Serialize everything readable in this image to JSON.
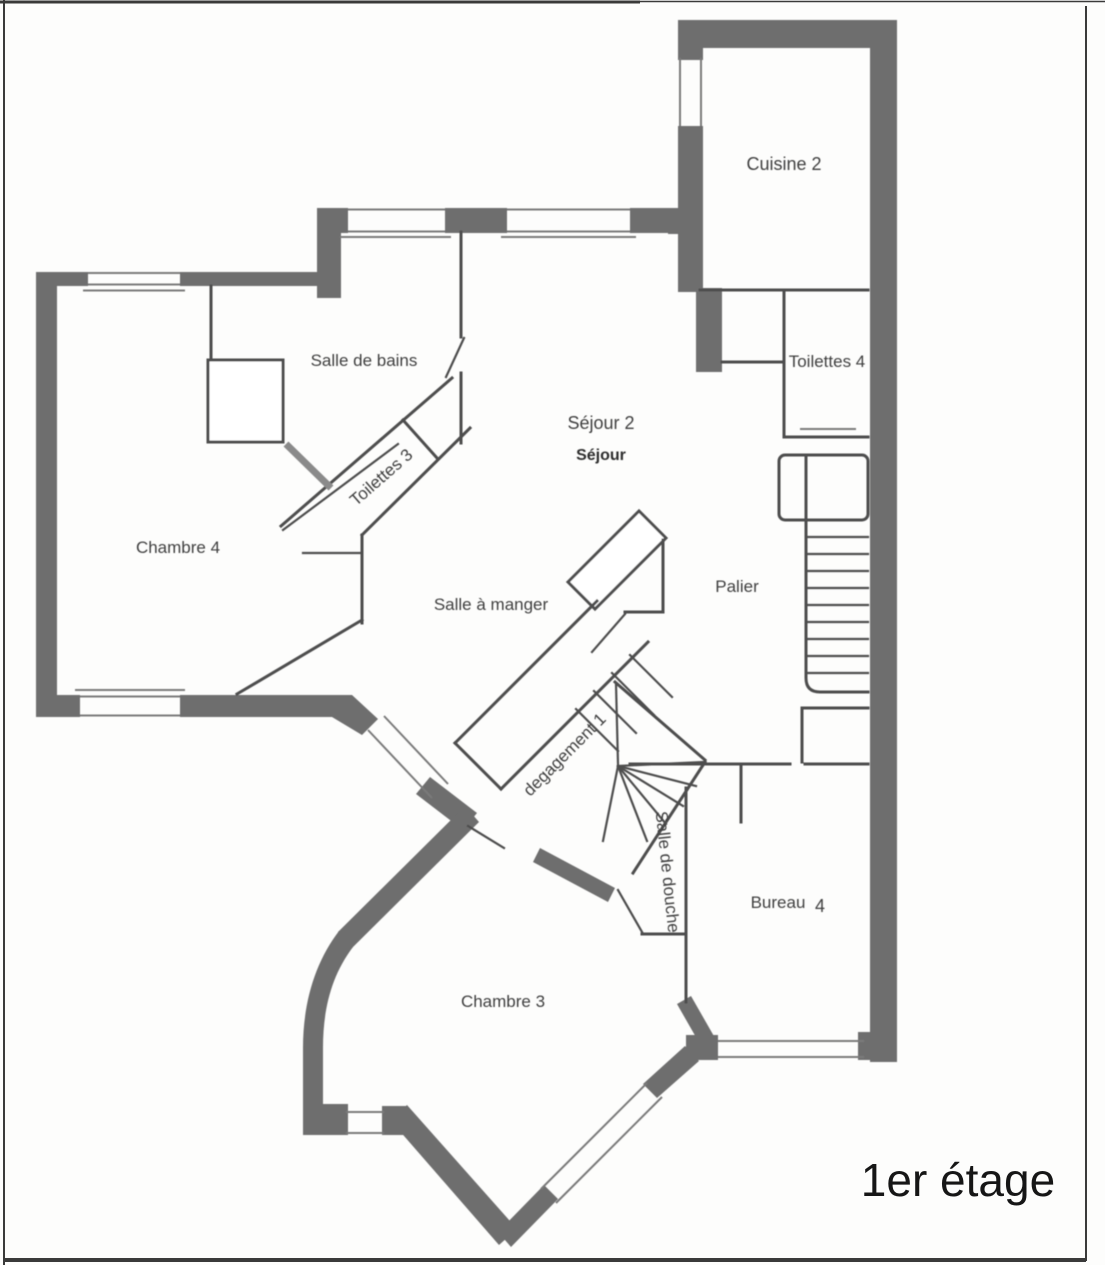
{
  "title": {
    "label": "1er étage"
  },
  "rooms": {
    "cuisine": {
      "label": "Cuisine 2"
    },
    "toilettes4": {
      "label": "Toilettes 4"
    },
    "sejour2": {
      "label": "Séjour 2"
    },
    "sejour": {
      "label": "Séjour"
    },
    "salle_de_bains": {
      "label": "Salle de bains"
    },
    "toilettes3": {
      "label": "Toilettes 3"
    },
    "chambre4": {
      "label": "Chambre 4"
    },
    "salle_a_manger": {
      "label": "Salle à manger"
    },
    "palier": {
      "label": "Palier"
    },
    "degagement": {
      "label": "degagement 1"
    },
    "salle_de_douche": {
      "label": "Salle de douche"
    },
    "bureau": {
      "label": "Bureau",
      "number": "4"
    },
    "chambre3": {
      "label": "Chambre 3"
    }
  },
  "colors": {
    "wall": "#6e6e6e",
    "line": "#4e4e4e",
    "window_line": "#7a7a7a",
    "label_ink": "#3f3f3f",
    "title_ink": "#161616",
    "paper": "#fdfdfc"
  }
}
